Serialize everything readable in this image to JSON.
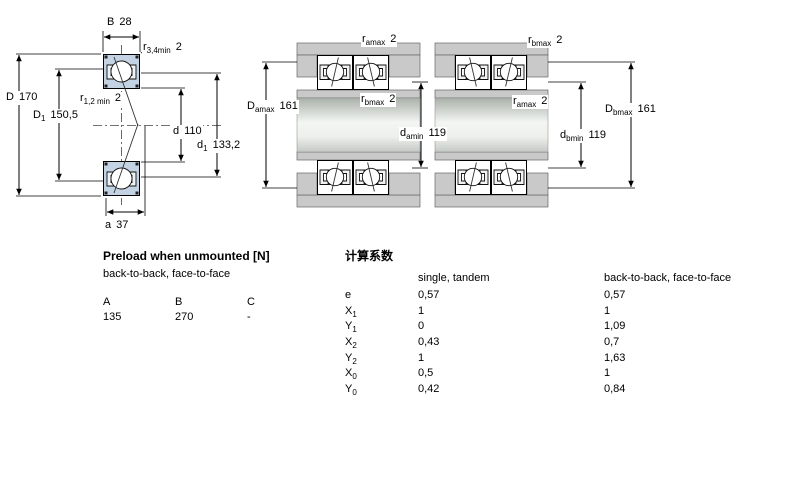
{
  "colors": {
    "bearing_fill": "#c4d3e3",
    "metal_gray": "#c9c9c9",
    "seat_gray": "#bfc3bf"
  },
  "drawing": {
    "left": {
      "dims": {
        "B": {
          "main": "B",
          "sub": "",
          "value": "28"
        },
        "r34": {
          "main": "r",
          "sub": "3,4min",
          "value": "2"
        },
        "D": {
          "main": "D",
          "sub": "",
          "value": "170"
        },
        "D1": {
          "main": "D",
          "sub": "1",
          "value": "150,5"
        },
        "r12": {
          "main": "r",
          "sub": "1,2 min",
          "value": "2"
        },
        "d": {
          "main": "d",
          "sub": "",
          "value": "110"
        },
        "d1": {
          "main": "d",
          "sub": "1",
          "value": "133,2"
        },
        "a": {
          "main": "a",
          "sub": "",
          "value": "37"
        }
      }
    },
    "middle": {
      "dims": {
        "r_top": {
          "main": "r",
          "sub": "amax",
          "value": "2"
        },
        "Damax": {
          "main": "D",
          "sub": "amax",
          "value": "161"
        },
        "r_mid": {
          "main": "r",
          "sub": "bmax",
          "value": "2"
        },
        "damin": {
          "main": "d",
          "sub": "amin",
          "value": "119"
        }
      }
    },
    "right": {
      "dims": {
        "r_top": {
          "main": "r",
          "sub": "bmax",
          "value": "2"
        },
        "r_mid": {
          "main": "r",
          "sub": "amax",
          "value": "2"
        },
        "Dbmax": {
          "main": "D",
          "sub": "bmax",
          "value": "161"
        },
        "dbmin": {
          "main": "d",
          "sub": "bmin",
          "value": "119"
        }
      }
    }
  },
  "preload_table": {
    "title": "Preload when unmounted [N]",
    "subtitle": "back-to-back, face-to-face",
    "columns": [
      "A",
      "B",
      "C"
    ],
    "values": [
      "135",
      "270",
      "-"
    ]
  },
  "factors_table": {
    "title": "计算系数",
    "col1_header": "single, tandem",
    "col2_header": "back-to-back, face-to-face",
    "rows": [
      {
        "label": {
          "main": "e",
          "sub": ""
        },
        "single": "0,57",
        "paired": "0,57"
      },
      {
        "label": {
          "main": "X",
          "sub": "1"
        },
        "single": "1",
        "paired": "1"
      },
      {
        "label": {
          "main": "Y",
          "sub": "1"
        },
        "single": "0",
        "paired": "1,09"
      },
      {
        "label": {
          "main": "X",
          "sub": "2"
        },
        "single": "0,43",
        "paired": "0,7"
      },
      {
        "label": {
          "main": "Y",
          "sub": "2"
        },
        "single": "1",
        "paired": "1,63"
      },
      {
        "label": {
          "main": "X",
          "sub": "0"
        },
        "single": "0,5",
        "paired": "1"
      },
      {
        "label": {
          "main": "Y",
          "sub": "0"
        },
        "single": "0,42",
        "paired": "0,84"
      }
    ]
  }
}
